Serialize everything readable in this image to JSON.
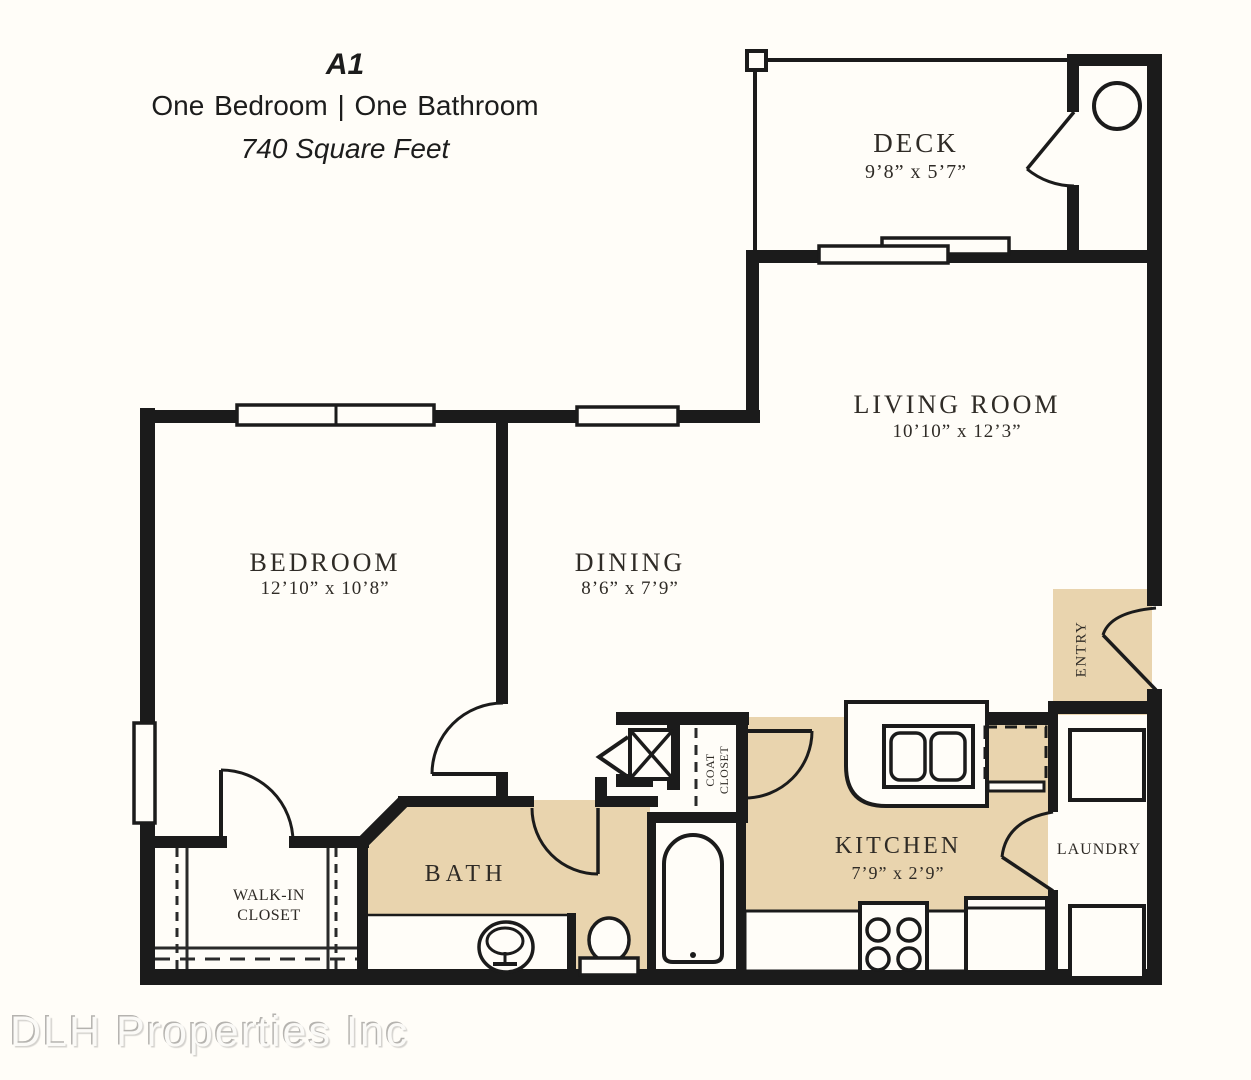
{
  "header": {
    "plan_code": "A1",
    "subtitle": "One Bedroom   |   One Bathroom",
    "area": "740 Square Feet"
  },
  "rooms": {
    "deck": {
      "name": "DECK",
      "dims": "9’8” x 5’7”"
    },
    "living": {
      "name": "LIVING ROOM",
      "dims": "10’10” x 12’3”"
    },
    "bedroom": {
      "name": "BEDROOM",
      "dims": "12’10” x 10’8”"
    },
    "dining": {
      "name": "DINING",
      "dims": "8’6” x 7’9”"
    },
    "kitchen": {
      "name": "KITCHEN",
      "dims": "7’9” x 2’9”"
    },
    "bath": {
      "name": "BATH"
    },
    "laundry": {
      "name": "LAUNDRY"
    },
    "walkin_closet": {
      "name": "WALK-IN CLOSET"
    },
    "coat_closet": {
      "name": "COAT CLOSET"
    },
    "entry": {
      "name": "ENTRY"
    }
  },
  "watermark": "DLH Properties Inc",
  "colors": {
    "floor_accent": "#e9d4ae",
    "wall": "#1b1b1b",
    "background": "#fffdf8"
  }
}
